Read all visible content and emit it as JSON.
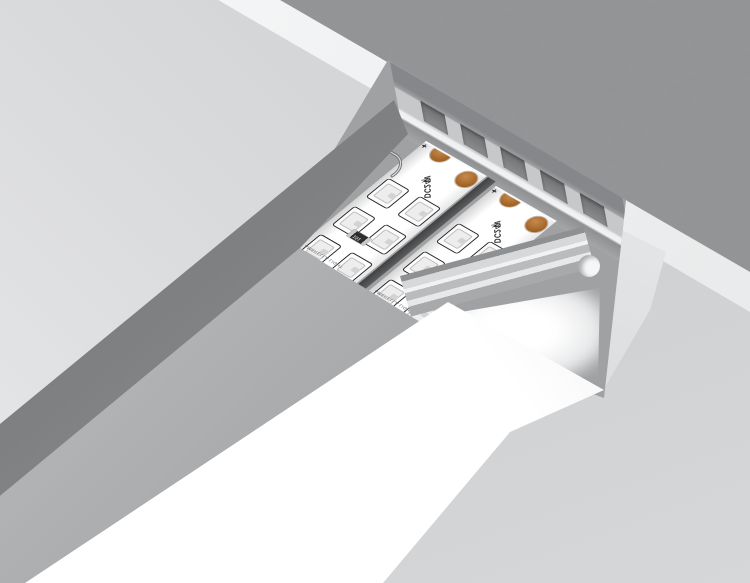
{
  "led_strip": {
    "polarity_mark": "+",
    "voltage_label": "DC24V",
    "resistor_code": "151",
    "brand_label": "AMBRELLA LIGHT",
    "scissors_glyph": "✂"
  },
  "colors": {
    "copper_pad": "#a96a2c",
    "concrete": "#8f9193",
    "drywall_cut_edge": "#f3f4f5",
    "ceiling_face": "#d8dadc",
    "slot_shadow": "#7b7d7f",
    "aluminum_profile": "#c6c8ca",
    "diffuser_white": "#ffffff",
    "pcb_white": "#ffffff"
  }
}
